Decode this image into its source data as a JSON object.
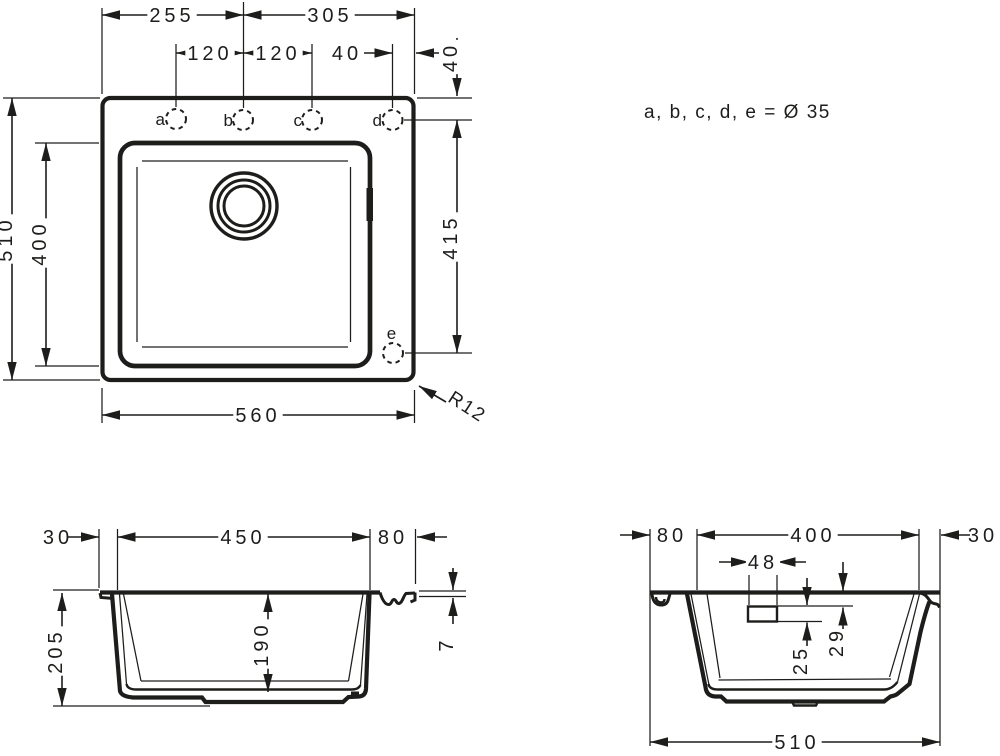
{
  "top_view": {
    "note": "a, b, c, d, e = Ø 35",
    "corner_radius_label": "R12",
    "holes": [
      {
        "label": "a"
      },
      {
        "label": "b"
      },
      {
        "label": "c"
      },
      {
        "label": "d"
      },
      {
        "label": "e"
      }
    ],
    "dims": {
      "left_to_hole_b": "255",
      "hole_b_to_right": "305",
      "hole_a_to_b": "120",
      "hole_b_to_c": "120",
      "hole_d_to_edge": "40",
      "edge_to_hole_row": "40",
      "overall_depth": "510",
      "bowl_depth": "400",
      "hole_row_to_hole_e": "415",
      "overall_width": "560"
    }
  },
  "front_section": {
    "dims": {
      "left_edge": "30",
      "bowl_width": "450",
      "right_edge": "80",
      "total_height": "205",
      "bowl_height": "190",
      "rim_thickness": "7"
    }
  },
  "side_section": {
    "dims": {
      "rear_edge": "80",
      "bowl_length": "400",
      "front_edge": "30",
      "overflow_width": "48",
      "overflow_offset": "29",
      "overflow_height": "25",
      "overall_length": "510"
    }
  },
  "colors": {
    "ink": "#1d1d1b",
    "paper": "#ffffff"
  }
}
